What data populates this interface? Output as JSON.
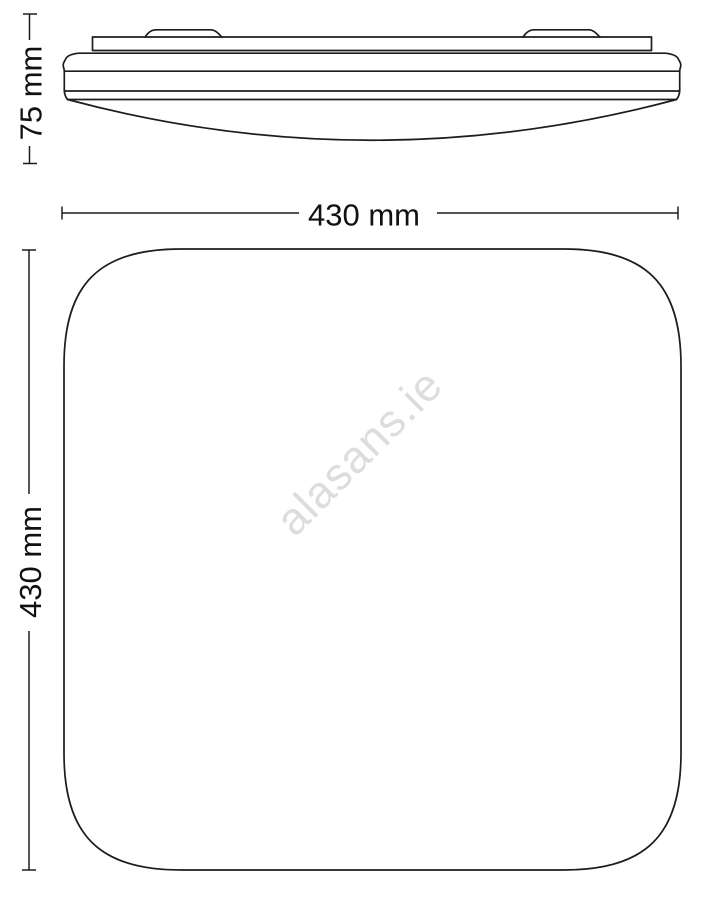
{
  "drawing": {
    "side_view": {
      "height_dimension": {
        "label": "75 mm"
      },
      "width_dimension": {
        "label": "430 mm"
      }
    },
    "top_view": {
      "height_dimension": {
        "label": "430 mm"
      }
    },
    "watermark": {
      "text": "alasans.ie"
    },
    "colors": {
      "background": "#ffffff",
      "line": "#1d1d1d",
      "text": "#111111",
      "watermark": "#dddddd"
    }
  }
}
